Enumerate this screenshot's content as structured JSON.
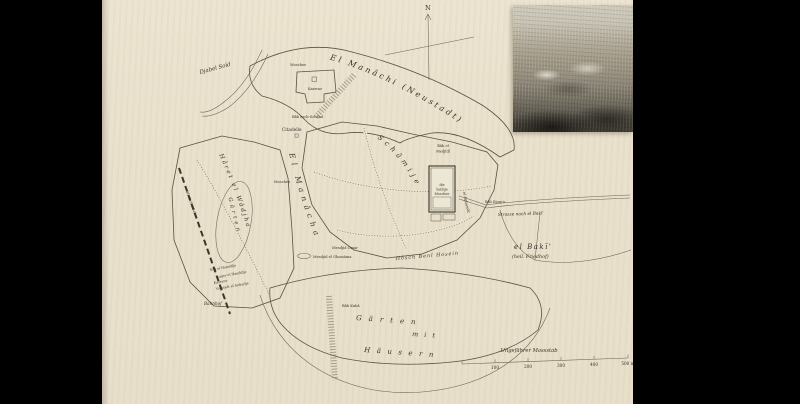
{
  "colors": {
    "page_bg": "#e9e1cc",
    "ink": "#3a342a",
    "letterbox": "#000000"
  },
  "map": {
    "labels": {
      "compass_n": "N",
      "manachi": "El Manâchi (Neustadt)",
      "djabel_soid": "Djabel Soïd",
      "moschee_top": "Moschee",
      "kaserne": "Kaserne",
      "bab_schami": "Bâb esch-Schâmî",
      "citadelle": "Citadelle",
      "schamije": "Schâmije",
      "bab_medjidi_1": "Bâb el",
      "bab_medjidi_2": "Medjîdî",
      "mosque_1": "die",
      "mosque_2": "heilige",
      "mosque_3": "Moschee",
      "aghawat": "el Aghawât",
      "bab_djuma": "Bâb Djum'a",
      "strasse_baki": "Strasse nach el Bakī'",
      "baki": "el Bakī'",
      "baki_sub": "(heil. Friedhof)",
      "hosch": "Hôsch Benî Hosein",
      "mesdjid_omar": "Mesdjid Omar",
      "mesdjid_ghomama": "Mesdjid el Ghomâma",
      "manacha": "El Manâcha",
      "moschee_strip": "Moschee",
      "haret": "Hâret el Wâdjha",
      "gaerten_west": "Gärten",
      "suq": "Sûq el Hamîdîje",
      "lager": "Lager el Hamîdîje",
      "kaserne2": "Kaserne",
      "vorstadt": "Vorstadt el Anbarîje",
      "bahnhof": "Bahnhof",
      "hedschasbahn": "Hedschasbahn",
      "bab_kuba": "Bâb Kubâ",
      "gm_1": "Gärten",
      "gm_2": "mit",
      "gm_3": "Häusern"
    },
    "scale": {
      "title": "Ungefährer Massstab",
      "ticks": [
        "100",
        "200",
        "300",
        "400",
        "500 m"
      ]
    }
  }
}
